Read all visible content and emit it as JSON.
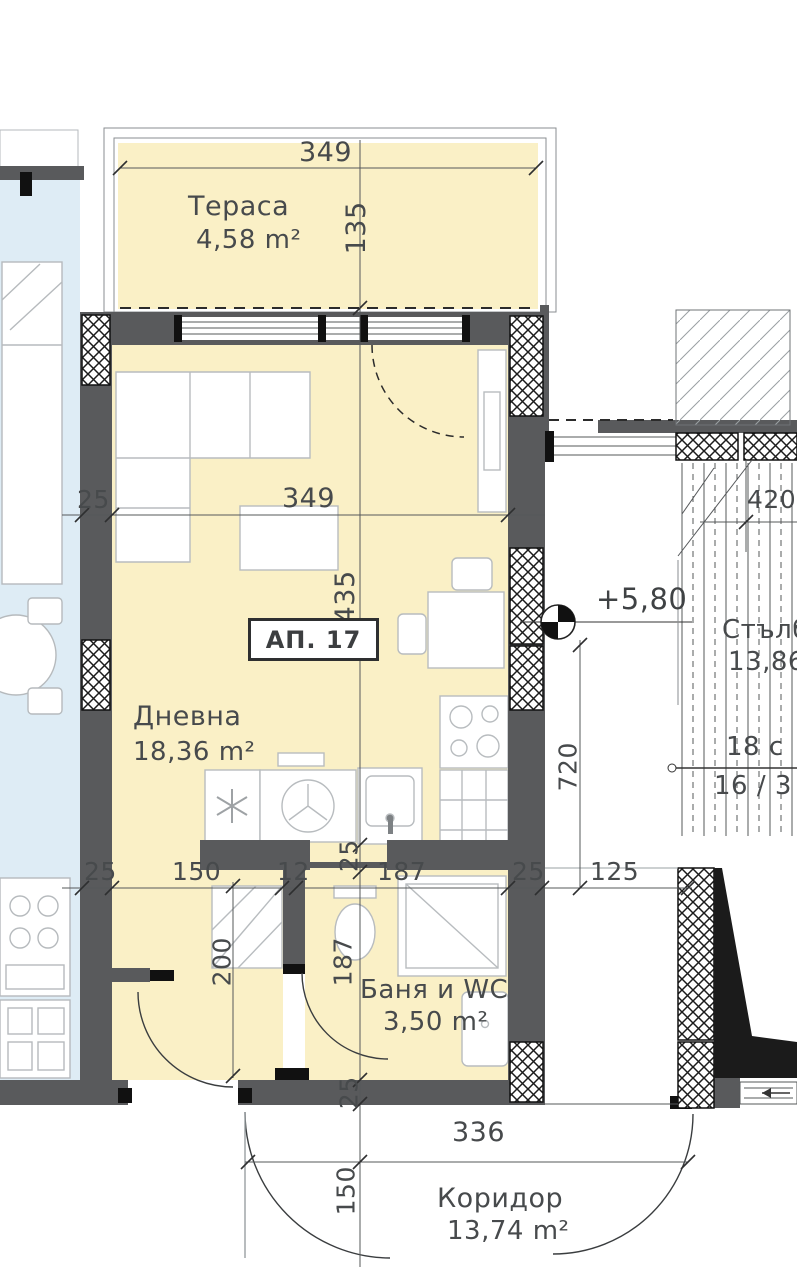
{
  "plan": {
    "apartment_label": "АП. 17",
    "level_mark": "+5,80",
    "rooms": {
      "terrace": {
        "name": "Тераса",
        "area": "4,58 m²"
      },
      "living": {
        "name": "Дневна",
        "area": "18,36 m²"
      },
      "bath": {
        "name": "Баня и WC",
        "area": "3,50 m²"
      },
      "corridor": {
        "name": "Коридор",
        "area": "13,74 m²"
      },
      "stairs": {
        "name": "Стълби",
        "area": "13,86"
      }
    },
    "stairs_notation": {
      "upper": "18 с",
      "lower": "16 / 3"
    },
    "dimensions": {
      "terrace_width": "349",
      "terrace_depth": "135",
      "living_width": "349",
      "living_length": "435",
      "left_wall": "25",
      "row": {
        "wall_a": "25",
        "hall": "150",
        "partition": "12",
        "bath_width": "187",
        "wall_b": "25",
        "stair_gap": "125"
      },
      "stairs_depth": "720",
      "hall_depth": "200",
      "bath_depth": "187",
      "kitchen_wall": "25",
      "bottom_wall": "25",
      "corridor_door": "150",
      "corridor_width": "336",
      "stairs_width": "420"
    },
    "colors": {
      "room_fill": "#FAF0C6",
      "adjacent_fill": "#DEECF5",
      "wall": "#595A5C",
      "line": "#55585A",
      "text": "#474A4C"
    }
  }
}
